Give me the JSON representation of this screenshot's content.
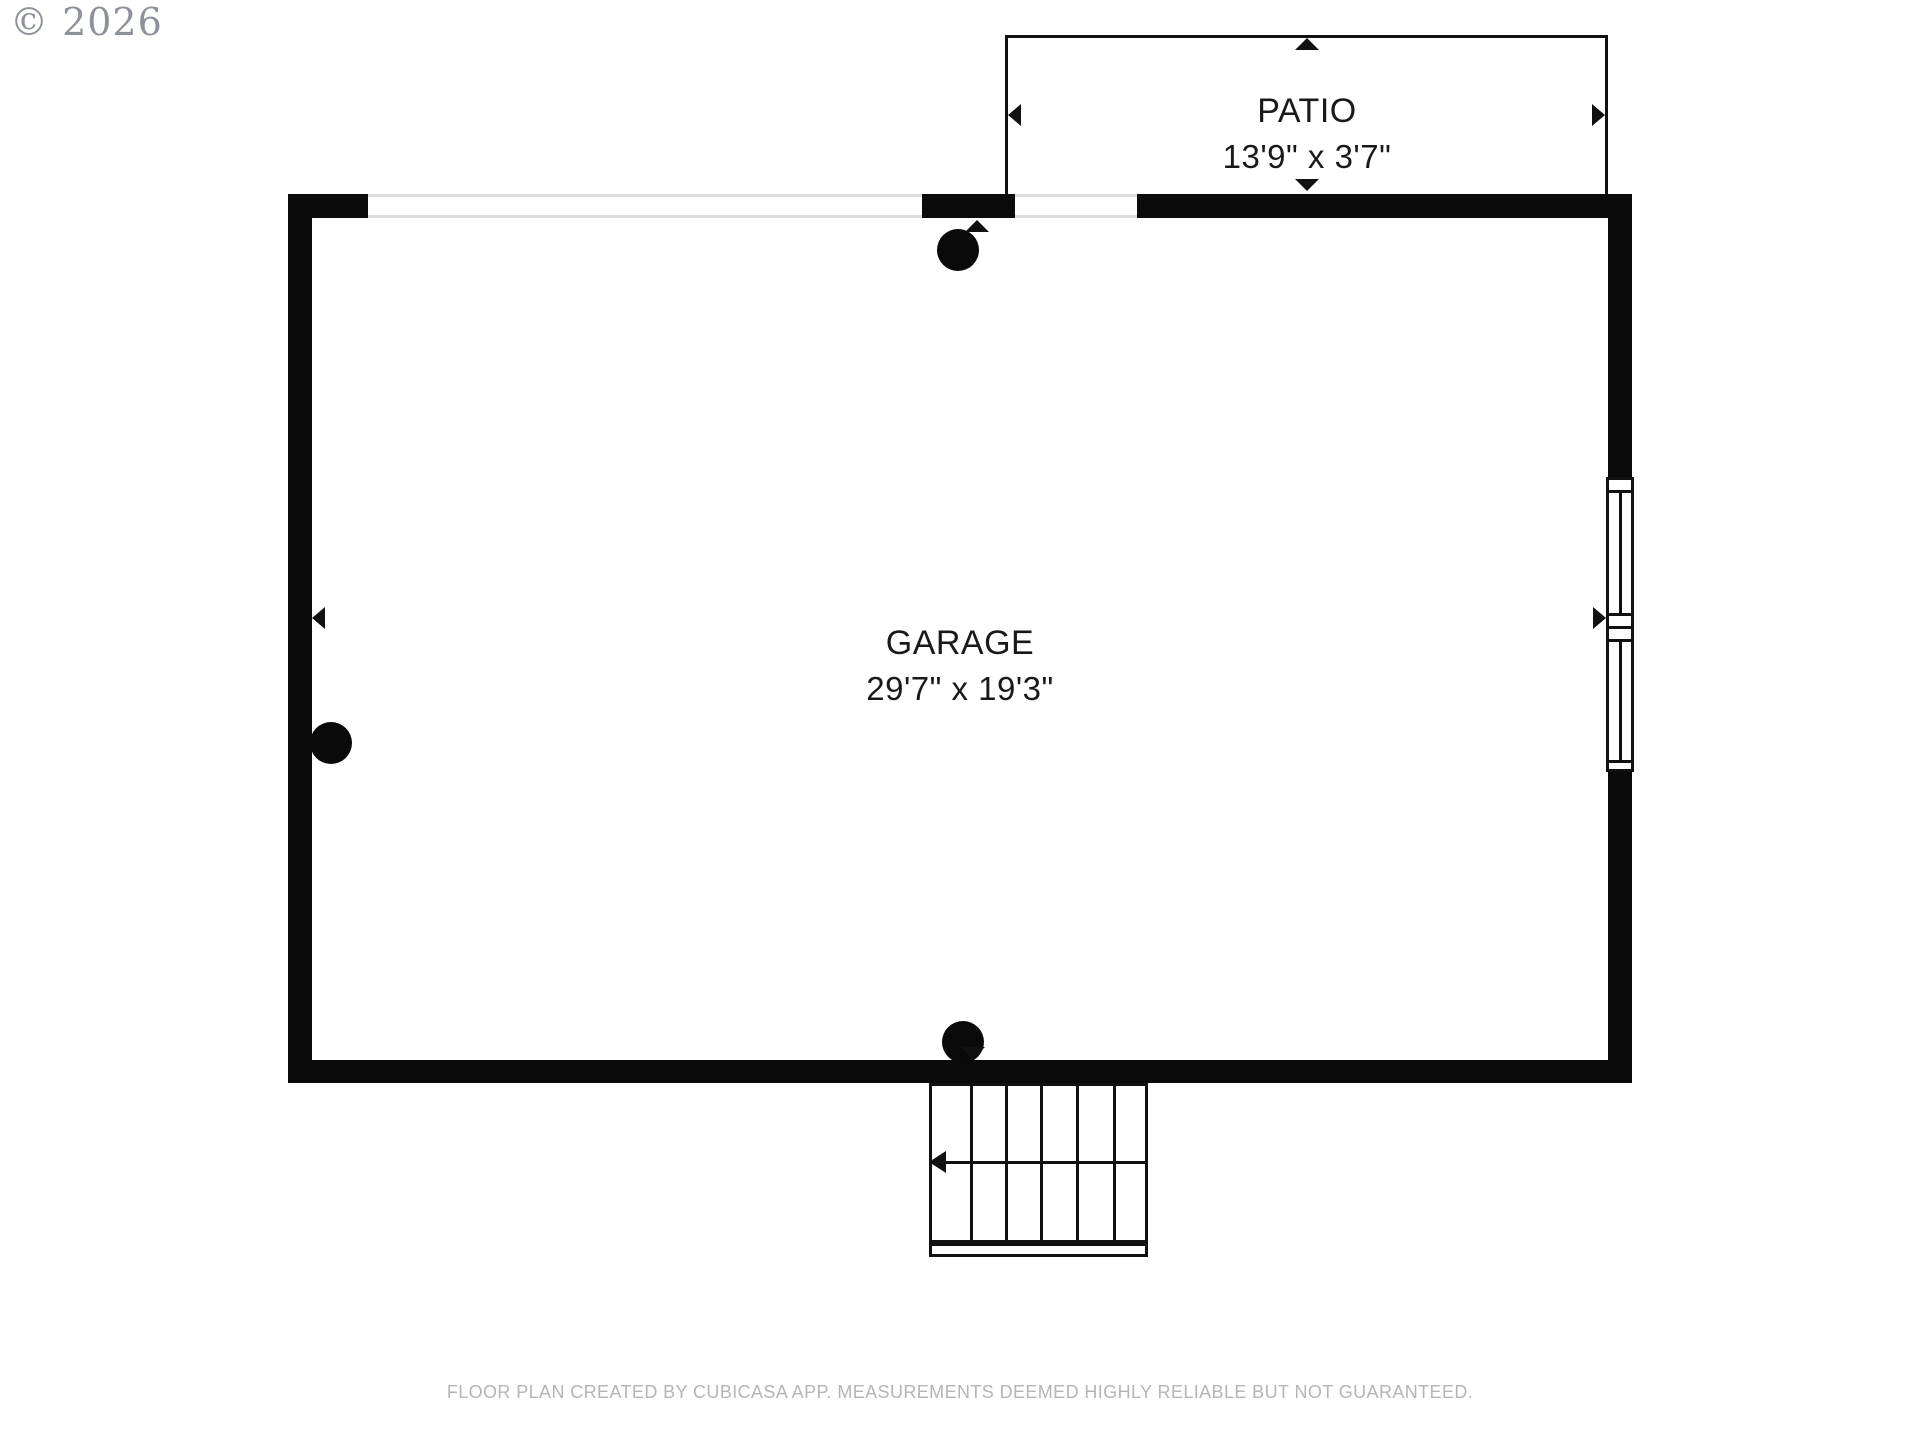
{
  "watermark": {
    "copyright": "© 2026"
  },
  "rooms": [
    {
      "name": "GARAGE",
      "dimensions": "29'7\" x 19'3\""
    },
    {
      "name": "PATIO",
      "dimensions": "13'9\" x 3'7\""
    }
  ],
  "footer": {
    "disclaimer": "FLOOR PLAN CREATED BY CUBICASA APP. MEASUREMENTS DEEMED HIGHLY RELIABLE BUT NOT GUARANTEED."
  },
  "colors": {
    "wall": "#0a0a0a",
    "text": "#191919",
    "opening_line": "#dedede",
    "watermark": "#8c919a",
    "footer_text": "#b5b5b5"
  }
}
